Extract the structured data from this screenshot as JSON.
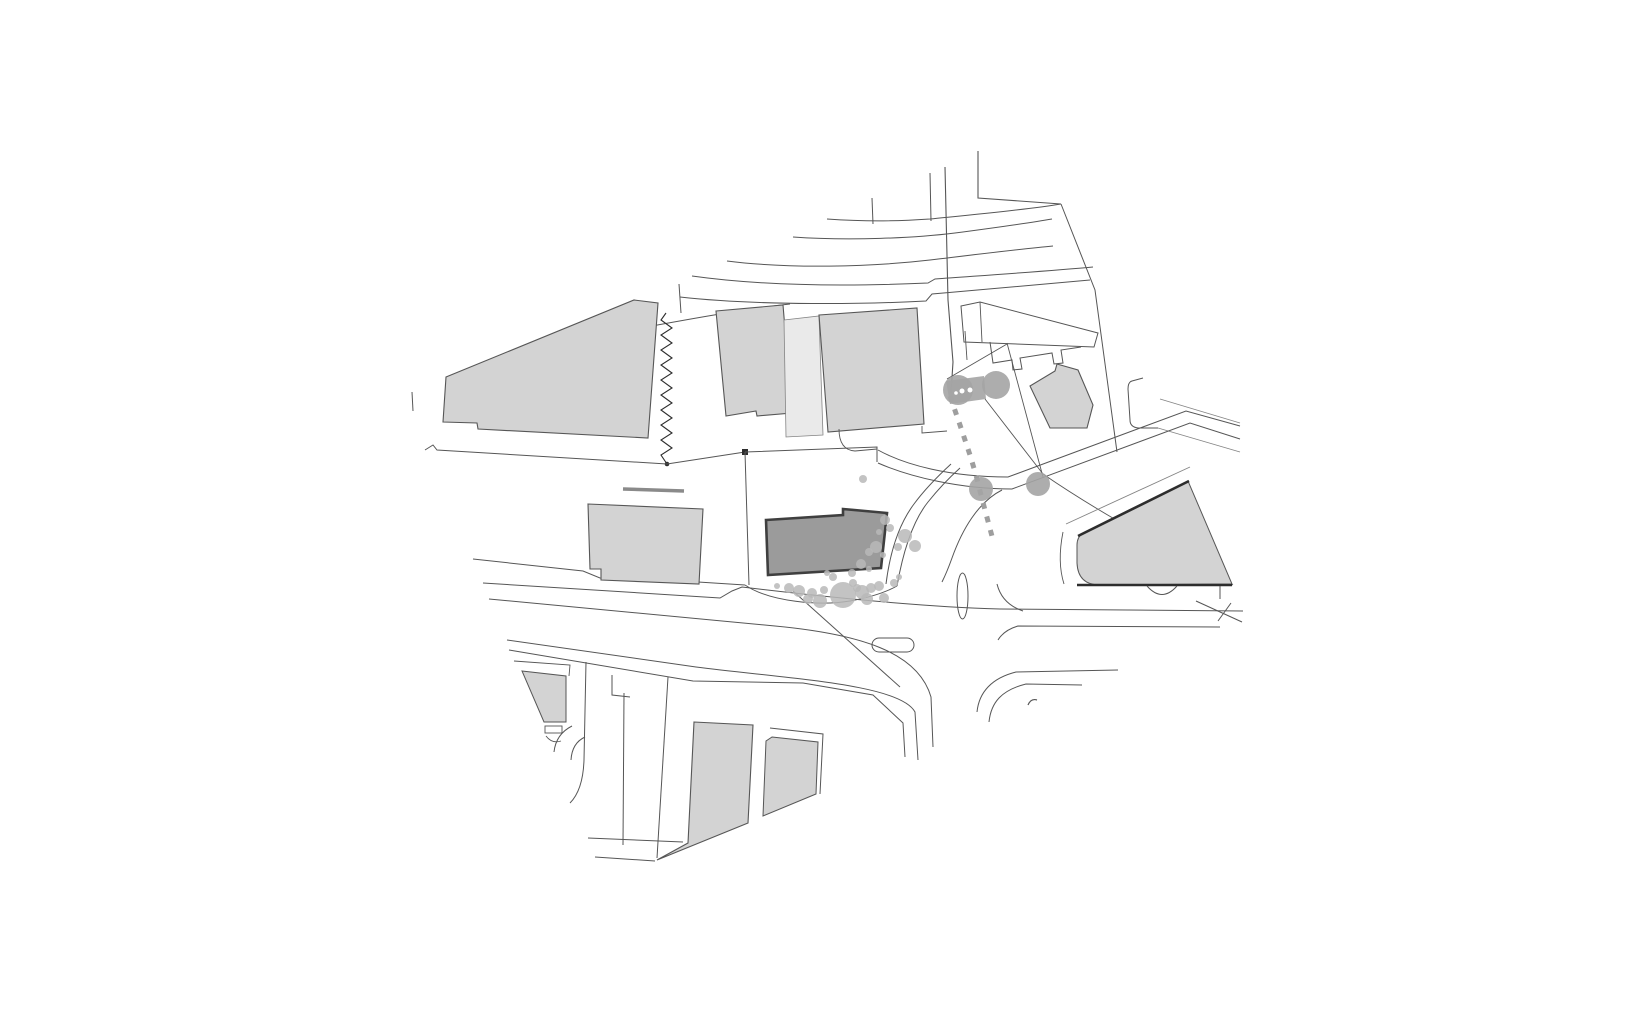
{
  "canvas": {
    "width": 1640,
    "height": 1020,
    "background": "#ffffff"
  },
  "palette": {
    "bld": "#d3d3d3",
    "bldL": "#eaeaea",
    "main": "#9b9b9b",
    "mainStroke": "#3f3f3f",
    "line": "#565656",
    "lineFaint": "#848484",
    "lineDark": "#2d2d2d",
    "wall": "#8a8a8a",
    "tree": "#a4a4a4",
    "shrub": "#b9b9b9",
    "dash": "#9e9e9e",
    "white": "#ffffff"
  },
  "shapes": [
    {
      "n": "upper-road-hook",
      "t": "path",
      "a": {
        "d": "M978,151 L978,198 L1061,204"
      },
      "f": "none",
      "s": "line",
      "w": 1.1
    },
    {
      "n": "upper-road-curve-1",
      "t": "path",
      "a": {
        "d": "M827,219 C870,222 900,221 930,219 C970,215 1025,210 1061,204"
      },
      "f": "none",
      "s": "line",
      "w": 1
    },
    {
      "n": "upper-road-stub-1",
      "t": "path",
      "a": {
        "d": "M930,173 L931,221"
      },
      "f": "none",
      "s": "line",
      "w": 1
    },
    {
      "n": "upper-road-stub-2",
      "t": "path",
      "a": {
        "d": "M872,198 L873,224"
      },
      "f": "none",
      "s": "line",
      "w": 1
    },
    {
      "n": "upper-road-curve-2",
      "t": "path",
      "a": {
        "d": "M793,237 C850,241 915,238 955,233 C1000,227 1035,222 1052,219"
      },
      "f": "none",
      "s": "line",
      "w": 1
    },
    {
      "n": "upper-road-curve-3",
      "t": "path",
      "a": {
        "d": "M727,261 C790,269 870,267 930,260 C980,254 1020,249 1053,246"
      },
      "f": "none",
      "s": "line",
      "w": 1
    },
    {
      "n": "upper-road-curve-4",
      "t": "path",
      "a": {
        "d": "M692,276 C770,287 860,286 928,283 L935,279 C990,275 1050,271 1093,267"
      },
      "f": "none",
      "s": "line",
      "w": 1
    },
    {
      "n": "upper-road-curve-5",
      "t": "path",
      "a": {
        "d": "M680,297 C760,306 870,304 926,301 L932,294 C990,289 1050,284 1090,280"
      },
      "f": "none",
      "s": "line",
      "w": 1
    },
    {
      "n": "survey-line-vertical",
      "t": "path",
      "a": {
        "d": "M945,167 L948,300 L953,362 L951,393"
      },
      "f": "none",
      "s": "line",
      "w": 1.1
    },
    {
      "n": "lot-boundary-upper",
      "t": "path",
      "a": {
        "d": "M641,328 C690,319 745,309 790,304"
      },
      "f": "none",
      "s": "line",
      "w": 1
    },
    {
      "n": "tick-far-left",
      "t": "path",
      "a": {
        "d": "M412,392 L413,411"
      },
      "f": "none",
      "s": "line",
      "w": 1
    },
    {
      "n": "tick-mid-upper",
      "t": "path",
      "a": {
        "d": "M679,284 L681,313"
      },
      "f": "none",
      "s": "line",
      "w": 1
    },
    {
      "n": "building-northwest-large",
      "t": "polygon",
      "a": {
        "points": "446,377 634,300 658,303 648,438 478,429 477,423 443,422"
      },
      "f": "bld",
      "s": "line",
      "w": 1.1
    },
    {
      "n": "zigzag-property-line",
      "t": "path",
      "a": {
        "d": "M666,313 L661,320 L672,328 L661,335 L672,343 L661,350 L672,358 L661,365 L672,373 L661,380 L672,388 L661,395 L672,403 L661,410 L672,418 L661,425 L672,433 L661,440 L672,448 L661,455 L667,464"
      },
      "f": "none",
      "s": "lineDark",
      "w": 1.1
    },
    {
      "n": "zigzag-end-dot",
      "t": "circle",
      "a": {
        "cx": "667",
        "cy": "464",
        "r": "2.3"
      },
      "f": "lineDark",
      "s": "none",
      "w": 0
    },
    {
      "n": "road-edge-under-nw-building",
      "t": "path",
      "a": {
        "d": "M425,450 L433,445 L437,450 L667,464 L745,452"
      },
      "f": "none",
      "s": "line",
      "w": 1
    },
    {
      "n": "parcel-corner-dot",
      "t": "rect",
      "a": {
        "x": "742",
        "y": "449",
        "width": "6",
        "height": "6"
      },
      "f": "lineDark",
      "s": "none",
      "w": 0
    },
    {
      "n": "building-north-a",
      "t": "polygon",
      "a": {
        "points": "716,311 783,305 792,413 757,416 756,411 726,416"
      },
      "f": "bld",
      "s": "line",
      "w": 1.1
    },
    {
      "n": "building-north-connector",
      "t": "polygon",
      "a": {
        "points": "784,320 819,316 823,435 786,437"
      },
      "f": "bldL",
      "s": "lineFaint",
      "w": 0.8
    },
    {
      "n": "building-north-b",
      "t": "polygon",
      "a": {
        "points": "819,315 917,308 924,424 828,432"
      },
      "f": "bld",
      "s": "line",
      "w": 1.1
    },
    {
      "n": "step-right-of-north-b",
      "t": "path",
      "a": {
        "d": "M922,426 L922,433 L947,431"
      },
      "f": "none",
      "s": "line",
      "w": 0.9
    },
    {
      "n": "driveway-curve-parcel",
      "t": "path",
      "a": {
        "d": "M839,429 Q839,450 855,451 L877,449"
      },
      "f": "none",
      "s": "line",
      "w": 0.9
    },
    {
      "n": "outline-building-slab-ne",
      "t": "polygon",
      "a": {
        "points": "961,306 980,302 1098,333 1094,347 964,342"
      },
      "f": "white",
      "s": "line",
      "w": 1
    },
    {
      "n": "slab-division-line",
      "t": "path",
      "a": {
        "d": "M980,302 L982,342"
      },
      "f": "none",
      "s": "line",
      "w": 0.9
    },
    {
      "n": "slab-tick",
      "t": "path",
      "a": {
        "d": "M965,331 L967,360"
      },
      "f": "none",
      "s": "line",
      "w": 0.9
    },
    {
      "n": "outline-teeth-row-ne",
      "t": "path",
      "a": {
        "d": "M990,342 L993,363 L1012,360 L1013,370 L1022,369 L1020,358 L1052,353 L1054,364 L1063,363 L1061,350 L1081,347"
      },
      "f": "none",
      "s": "line",
      "w": 1
    },
    {
      "n": "boundary-ne-slant",
      "t": "path",
      "a": {
        "d": "M1007,343 L1043,477"
      },
      "f": "none",
      "s": "line",
      "w": 0.9
    },
    {
      "n": "boundary-hedge-top",
      "t": "path",
      "a": {
        "d": "M947,379 L1007,344"
      },
      "f": "none",
      "s": "line",
      "w": 0.9
    },
    {
      "n": "boundary-long-east",
      "t": "path",
      "a": {
        "d": "M1061,204 L1095,290 L1117,452"
      },
      "f": "none",
      "s": "line",
      "w": 1
    },
    {
      "n": "driveway-notch-east",
      "t": "path",
      "a": {
        "d": "M1143,378 L1132,381 Q1128,382 1128,389 L1130,420 Q1130,427 1138,428 L1158,428"
      },
      "f": "none",
      "s": "line",
      "w": 1
    },
    {
      "n": "east-road-edge-1",
      "t": "path",
      "a": {
        "d": "M1160,399 L1240,423"
      },
      "f": "none",
      "s": "lineFaint",
      "w": 0.9
    },
    {
      "n": "east-road-edge-2",
      "t": "path",
      "a": {
        "d": "M1158,428 L1240,452"
      },
      "f": "none",
      "s": "lineFaint",
      "w": 0.9
    },
    {
      "n": "boundary-diag-short",
      "t": "path",
      "a": {
        "d": "M985,399 L1043,474"
      },
      "f": "none",
      "s": "line",
      "w": 0.9
    },
    {
      "n": "boundary-diag-long",
      "t": "path",
      "a": {
        "d": "M1043,474 C1110,520 1175,552 1233,585"
      },
      "f": "none",
      "s": "line",
      "w": 0.9
    },
    {
      "n": "building-ne-rotated",
      "t": "polygon",
      "a": {
        "points": "1030,386 1055,371 1057,364 1078,370 1093,405 1087,428 1050,428"
      },
      "f": "bld",
      "s": "line",
      "w": 1.1
    },
    {
      "n": "parcel-west-edge",
      "t": "path",
      "a": {
        "d": "M745,452 L749,585"
      },
      "f": "none",
      "s": "line",
      "w": 1
    },
    {
      "n": "parcel-top-edge",
      "t": "path",
      "a": {
        "d": "M745,452 L877,447 L877,462"
      },
      "f": "none",
      "s": "line",
      "w": 1
    },
    {
      "n": "sidewalk-bulge-trees",
      "t": "path",
      "a": {
        "d": "M745,585 C770,602 820,606 850,601 C872,597 888,591 897,586"
      },
      "f": "none",
      "s": "line",
      "w": 1
    },
    {
      "n": "curved-band-inner",
      "t": "path",
      "a": {
        "d": "M886,584 C890,552 899,524 914,504 C925,489 938,476 951,464"
      },
      "f": "none",
      "s": "line",
      "w": 1
    },
    {
      "n": "curved-band-outer",
      "t": "path",
      "a": {
        "d": "M897,586 C903,552 912,522 928,502 C940,487 950,477 960,468"
      },
      "f": "none",
      "s": "line",
      "w": 1
    },
    {
      "n": "ne-road-curb-north",
      "t": "path",
      "a": {
        "d": "M878,450 C905,465 950,477 1008,477 L1186,411 L1240,426"
      },
      "f": "none",
      "s": "line",
      "w": 1
    },
    {
      "n": "ne-road-curb-south",
      "t": "path",
      "a": {
        "d": "M878,463 C910,477 960,489 1012,489 L1190,423 L1240,439"
      },
      "f": "none",
      "s": "line",
      "w": 1
    },
    {
      "n": "ne-road-corner-curve",
      "t": "path",
      "a": {
        "d": "M1002,490 C978,502 962,530 952,558 Q947,572 942,582"
      },
      "f": "none",
      "s": "line",
      "w": 1
    },
    {
      "n": "corner-arc-wedge-west",
      "t": "path",
      "a": {
        "d": "M997,584 Q1002,604 1023,611"
      },
      "f": "none",
      "s": "line",
      "w": 1
    },
    {
      "n": "sidewalk-above-wedge",
      "t": "path",
      "a": {
        "d": "M1066,524 L1190,467"
      },
      "f": "none",
      "s": "lineFaint",
      "w": 0.9
    },
    {
      "n": "curb-arc-left-of-wedge",
      "t": "path",
      "a": {
        "d": "M1063,532 Q1057,562 1064,584"
      },
      "f": "none",
      "s": "line",
      "w": 0.9
    },
    {
      "n": "building-wedge-east",
      "t": "path",
      "a": {
        "d": "M1083,533 L1188,481 L1232,584 L1100,585 Q1078,585 1077,563 L1077,545 Q1077,537 1083,533 Z"
      },
      "f": "bld",
      "s": "line",
      "w": 1
    },
    {
      "n": "wedge-retaining-wall-top",
      "t": "path",
      "a": {
        "d": "M1078,536 L1189,481"
      },
      "f": "none",
      "s": "lineDark",
      "w": 2.6
    },
    {
      "n": "wedge-retaining-wall-bottom",
      "t": "path",
      "a": {
        "d": "M1077,585 L1232,585"
      },
      "f": "none",
      "s": "lineDark",
      "w": 2.4
    },
    {
      "n": "wedge-bump-arc",
      "t": "path",
      "a": {
        "d": "M1147,586 Q1162,603 1177,586"
      },
      "f": "none",
      "s": "line",
      "w": 1
    },
    {
      "n": "wedge-right-tick",
      "t": "path",
      "a": {
        "d": "M1220,586 L1220,599"
      },
      "f": "none",
      "s": "line",
      "w": 1
    },
    {
      "n": "survey-x-line",
      "t": "path",
      "a": {
        "d": "M1196,601 L1242,622"
      },
      "f": "none",
      "s": "line",
      "w": 1
    },
    {
      "n": "survey-x-tick",
      "t": "path",
      "a": {
        "d": "M1218,621 L1231,603"
      },
      "f": "none",
      "s": "line",
      "w": 1
    },
    {
      "n": "apostrophe-mark",
      "t": "path",
      "a": {
        "d": "M1028,705 Q1031,698 1037,700"
      },
      "f": "none",
      "s": "line",
      "w": 1.2
    },
    {
      "n": "main-street-north-curb",
      "t": "path",
      "a": {
        "d": "M473,559 L583,571 L600,578 L698,582 L745,585"
      },
      "f": "none",
      "s": "line",
      "w": 1
    },
    {
      "n": "main-street-south-curb",
      "t": "path",
      "a": {
        "d": "M483,583 L720,598 L732,591 L742,587 C850,600 930,607 1000,609 L1243,611"
      },
      "f": "none",
      "s": "line",
      "w": 1
    },
    {
      "n": "main-street-lower-edge",
      "t": "path",
      "a": {
        "d": "M489,599 L775,626 C860,634 918,652 931,697 L933,747"
      },
      "f": "none",
      "s": "line",
      "w": 1
    },
    {
      "n": "sidewalk-line-a",
      "t": "path",
      "a": {
        "d": "M507,640 L696,667 C790,679 900,684 915,712 L918,760"
      },
      "f": "none",
      "s": "line",
      "w": 1
    },
    {
      "n": "sidewalk-line-b",
      "t": "path",
      "a": {
        "d": "M509,650 L693,681 L803,683 L873,695 L903,723 L905,757"
      },
      "f": "none",
      "s": "line",
      "w": 1
    },
    {
      "n": "curb-hook-south-street",
      "t": "path",
      "a": {
        "d": "M612,675 L612,695 L630,697"
      },
      "f": "none",
      "s": "line",
      "w": 1
    },
    {
      "n": "south-street-east-arc-1",
      "t": "path",
      "a": {
        "d": "M977,712 C979,692 992,678 1016,672 L1118,670"
      },
      "f": "none",
      "s": "line",
      "w": 1
    },
    {
      "n": "south-street-east-arc-2",
      "t": "path",
      "a": {
        "d": "M989,722 C991,702 1002,690 1026,684 L1082,685"
      },
      "f": "none",
      "s": "line",
      "w": 1
    },
    {
      "n": "main-street-far-lower-edge",
      "t": "path",
      "a": {
        "d": "M998,640 Q1004,630 1018,626 L1220,627"
      },
      "f": "none",
      "s": "line",
      "w": 1
    },
    {
      "n": "traffic-island-oval",
      "t": "ellipse",
      "a": {
        "cx": "962.5",
        "cy": "596",
        "rx": "5.5",
        "ry": "23"
      },
      "f": "none",
      "s": "line",
      "w": 1
    },
    {
      "n": "traffic-island-rounded",
      "t": "rect",
      "a": {
        "x": "872",
        "y": "638",
        "width": "42",
        "height": "14",
        "rx": "7"
      },
      "f": "none",
      "s": "line",
      "w": 1
    },
    {
      "n": "leader-line-diagonal",
      "t": "path",
      "a": {
        "d": "M793,591 L900,687"
      },
      "f": "none",
      "s": "line",
      "w": 1
    },
    {
      "n": "sw-street-curb-west",
      "t": "path",
      "a": {
        "d": "M586,662 L584,760 Q583,790 570,803"
      },
      "f": "none",
      "s": "line",
      "w": 1
    },
    {
      "n": "sw-street-line-mid",
      "t": "path",
      "a": {
        "d": "M624,693 L623,845"
      },
      "f": "none",
      "s": "line",
      "w": 1
    },
    {
      "n": "sw-street-line-east",
      "t": "path",
      "a": {
        "d": "M668,677 L657,858"
      },
      "f": "none",
      "s": "line",
      "w": 1
    },
    {
      "n": "sw-corner-arc-1",
      "t": "path",
      "a": {
        "d": "M572,726 Q556,734 554,752"
      },
      "f": "none",
      "s": "line",
      "w": 1
    },
    {
      "n": "sw-corner-arc-2",
      "t": "path",
      "a": {
        "d": "M585,737 Q572,743 571,760"
      },
      "f": "none",
      "s": "line",
      "w": 1
    },
    {
      "n": "sw-bottom-stub-1",
      "t": "path",
      "a": {
        "d": "M588,838 L683,842"
      },
      "f": "none",
      "s": "line",
      "w": 1
    },
    {
      "n": "sw-bottom-stub-2",
      "t": "path",
      "a": {
        "d": "M595,857 L655,861"
      },
      "f": "none",
      "s": "line",
      "w": 1
    },
    {
      "n": "outline-above-sw-wedge",
      "t": "path",
      "a": {
        "d": "M514,661 L570,665 L569,676"
      },
      "f": "none",
      "s": "line",
      "w": 0.9
    },
    {
      "n": "building-sw-wedge",
      "t": "polygon",
      "a": {
        "points": "522,671 566,676 566,722 544,722"
      },
      "f": "bld",
      "s": "line",
      "w": 1
    },
    {
      "n": "sw-wedge-step",
      "t": "rect",
      "a": {
        "x": "545",
        "y": "726",
        "width": "17",
        "height": "7"
      },
      "f": "none",
      "s": "line",
      "w": 0.9
    },
    {
      "n": "sw-wedge-hook",
      "t": "path",
      "a": {
        "d": "M546,736 Q552,744 561,741"
      },
      "f": "none",
      "s": "line",
      "w": 0.9
    },
    {
      "n": "building-south-parallelogram",
      "t": "polygon",
      "a": {
        "points": "694,722 753,725 748,823 657,860 688,843"
      },
      "f": "bld",
      "s": "line",
      "w": 1.1
    },
    {
      "n": "outline-south-building-b",
      "t": "path",
      "a": {
        "d": "M770,728 L823,734 L820,794"
      },
      "f": "none",
      "s": "line",
      "w": 1
    },
    {
      "n": "building-south-b",
      "t": "polygon",
      "a": {
        "points": "772,737 818,742 816,794 763,816 766,741"
      },
      "f": "bld",
      "s": "line",
      "w": 1
    },
    {
      "n": "building-west-small",
      "t": "polygon",
      "a": {
        "points": "588,504 703,509 699,584 601,580 601,569 590,569"
      },
      "f": "bld",
      "s": "line",
      "w": 1.1
    },
    {
      "n": "wall-segment-gray",
      "t": "path",
      "a": {
        "d": "M623,489 L684,491"
      },
      "f": "none",
      "s": "wall",
      "w": 3.5
    },
    {
      "n": "main-building-site",
      "t": "path",
      "a": {
        "d": "M766,520 L843,515 L843,509 L887,513 L881,568 L768,575 Z"
      },
      "f": "main",
      "s": "mainStroke",
      "w": 2.6
    },
    {
      "n": "footpath-dashed",
      "t": "path",
      "a": {
        "d": "M950,396 L960,425 L970,455 L976,475 L981,495 L993,540"
      },
      "f": "none",
      "s": "dash",
      "w": 5,
      "da": "6 8"
    },
    {
      "n": "hedge-block",
      "t": "polygon",
      "a": {
        "points": "946,381 984,376 986,399 950,404"
      },
      "f": "tree",
      "s": "none",
      "w": 0,
      "o": 0.9
    }
  ],
  "shrubs": [
    [
      777,
      586,
      3
    ],
    [
      789,
      588,
      5
    ],
    [
      799,
      591,
      6
    ],
    [
      812,
      593,
      5
    ],
    [
      824,
      590,
      4
    ],
    [
      833,
      577,
      4
    ],
    [
      827,
      573,
      3
    ],
    [
      843,
      595,
      13
    ],
    [
      862,
      592,
      7
    ],
    [
      871,
      588,
      5
    ],
    [
      879,
      586,
      5
    ],
    [
      867,
      599,
      6
    ],
    [
      884,
      598,
      5
    ],
    [
      820,
      601,
      7
    ],
    [
      808,
      599,
      5
    ],
    [
      853,
      583,
      4
    ],
    [
      885,
      520,
      5
    ],
    [
      890,
      528,
      4
    ],
    [
      879,
      532,
      3
    ],
    [
      876,
      547,
      6
    ],
    [
      869,
      552,
      4
    ],
    [
      883,
      555,
      3
    ],
    [
      861,
      564,
      5
    ],
    [
      869,
      569,
      3
    ],
    [
      852,
      573,
      4
    ],
    [
      857,
      588,
      4
    ],
    [
      894,
      583,
      4
    ],
    [
      899,
      577,
      3
    ],
    [
      905,
      536,
      7
    ],
    [
      915,
      546,
      6
    ],
    [
      898,
      547,
      4
    ],
    [
      863,
      479,
      4
    ]
  ],
  "trees": [
    [
      958,
      390,
      15
    ],
    [
      996,
      385,
      14
    ],
    [
      981,
      489,
      12
    ],
    [
      1038,
      484,
      12
    ]
  ],
  "hedge_dots": [
    [
      962,
      391,
      2.5
    ],
    [
      970,
      390,
      2.5
    ],
    [
      956,
      393,
      1.8
    ]
  ]
}
